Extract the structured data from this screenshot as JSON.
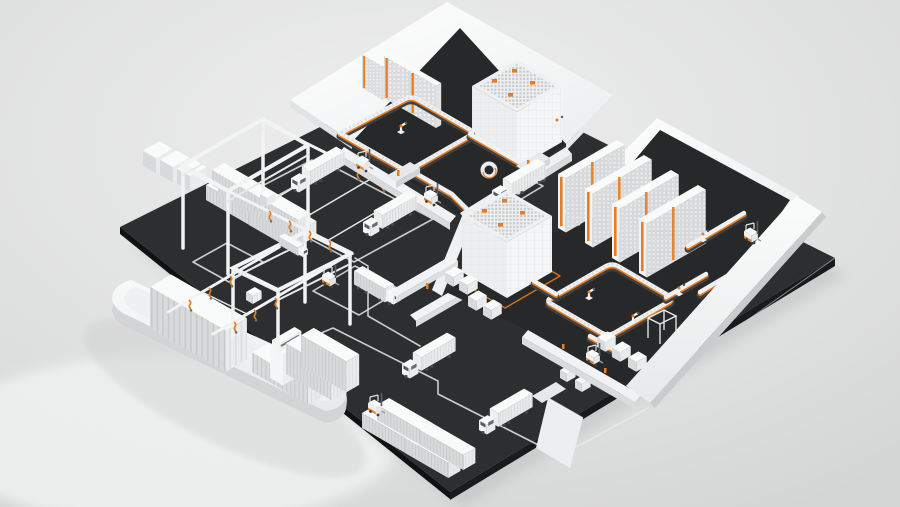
{
  "scene": {
    "type": "isometric-3d-render",
    "subject": "automated-logistics-facility",
    "objects": [
      {
        "name": "container-ship",
        "count": 1
      },
      {
        "name": "gantry-crane",
        "count": 2
      },
      {
        "name": "crane-hook-chain",
        "count": 14
      },
      {
        "name": "warehouse-building-cutaway",
        "count": 2
      },
      {
        "name": "high-bay-rack",
        "count": 7
      },
      {
        "name": "automated-storage-cube",
        "count": 2
      },
      {
        "name": "cube-shuttle-robot",
        "count": 8
      },
      {
        "name": "conveyor-line",
        "count": 11
      },
      {
        "name": "spiral-conveyor",
        "count": 1
      },
      {
        "name": "robot-arm",
        "count": 6
      },
      {
        "name": "palletizer-frame",
        "count": 1
      },
      {
        "name": "semi-truck",
        "count": 6
      },
      {
        "name": "box-truck",
        "count": 1
      },
      {
        "name": "forklift",
        "count": 6
      },
      {
        "name": "container-stack",
        "count": 3
      },
      {
        "name": "pallet-stack",
        "count": 12
      },
      {
        "name": "road-marking",
        "count": 7
      },
      {
        "name": "dock-ramp",
        "count": 4
      }
    ]
  },
  "palette": {
    "background": "#dfe0e0",
    "background_light": "#ededed",
    "platform": "#2d2e30",
    "platform_edge": "#18191a",
    "interior_floor": "#27282a",
    "white": "#fafbfb",
    "white_mid": "#ebedee",
    "white_shade": "#d8dadc",
    "accent": "#e87c1e",
    "road": "#e8e9e9",
    "glass": "#595b5e",
    "metal_dark": "#3f4144",
    "shadow": "#b9babb"
  }
}
